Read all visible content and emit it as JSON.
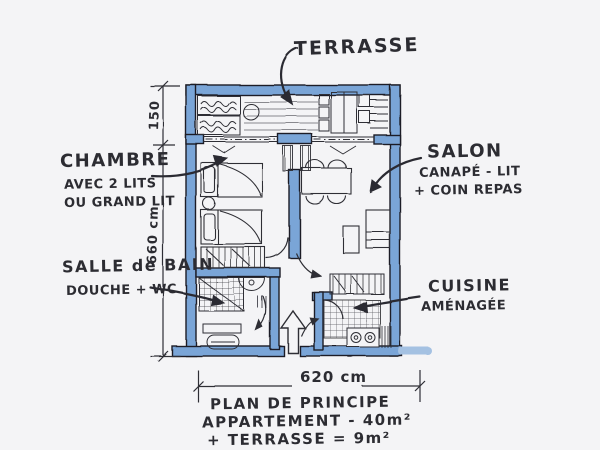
{
  "document_type": "hand-drawn apartment floor plan sketch",
  "rooms": {
    "terrasse": {
      "label": "TERRASSE"
    },
    "chambre": {
      "label": "CHAMBRE",
      "desc1": "AVEC 2 LITS",
      "desc2": "OU GRAND LIT"
    },
    "salon": {
      "label": "SALON",
      "desc1": "CANAPÉ - LIT",
      "desc2": "+ COIN REPAS"
    },
    "salle_de_bain": {
      "label": "SALLE de BAIN",
      "desc1": "DOUCHE + WC"
    },
    "cuisine": {
      "label": "CUISINE",
      "desc1": "AMÉNAGÉE"
    }
  },
  "dimensions": {
    "terrace_depth_cm": "150",
    "plan_height_cm": "660 cm",
    "plan_width_cm": "620 cm"
  },
  "caption": {
    "line1": "PLAN DE PRINCIPE",
    "line2": "APPARTEMENT - 40m²",
    "line3": "+ TERRASSE = 9m²"
  },
  "colors": {
    "paper": "#f4f4f6",
    "ink": "#2c2c32",
    "wall_blue": "#7aa5d7",
    "wall_blue_light": "#a4c1e2"
  }
}
